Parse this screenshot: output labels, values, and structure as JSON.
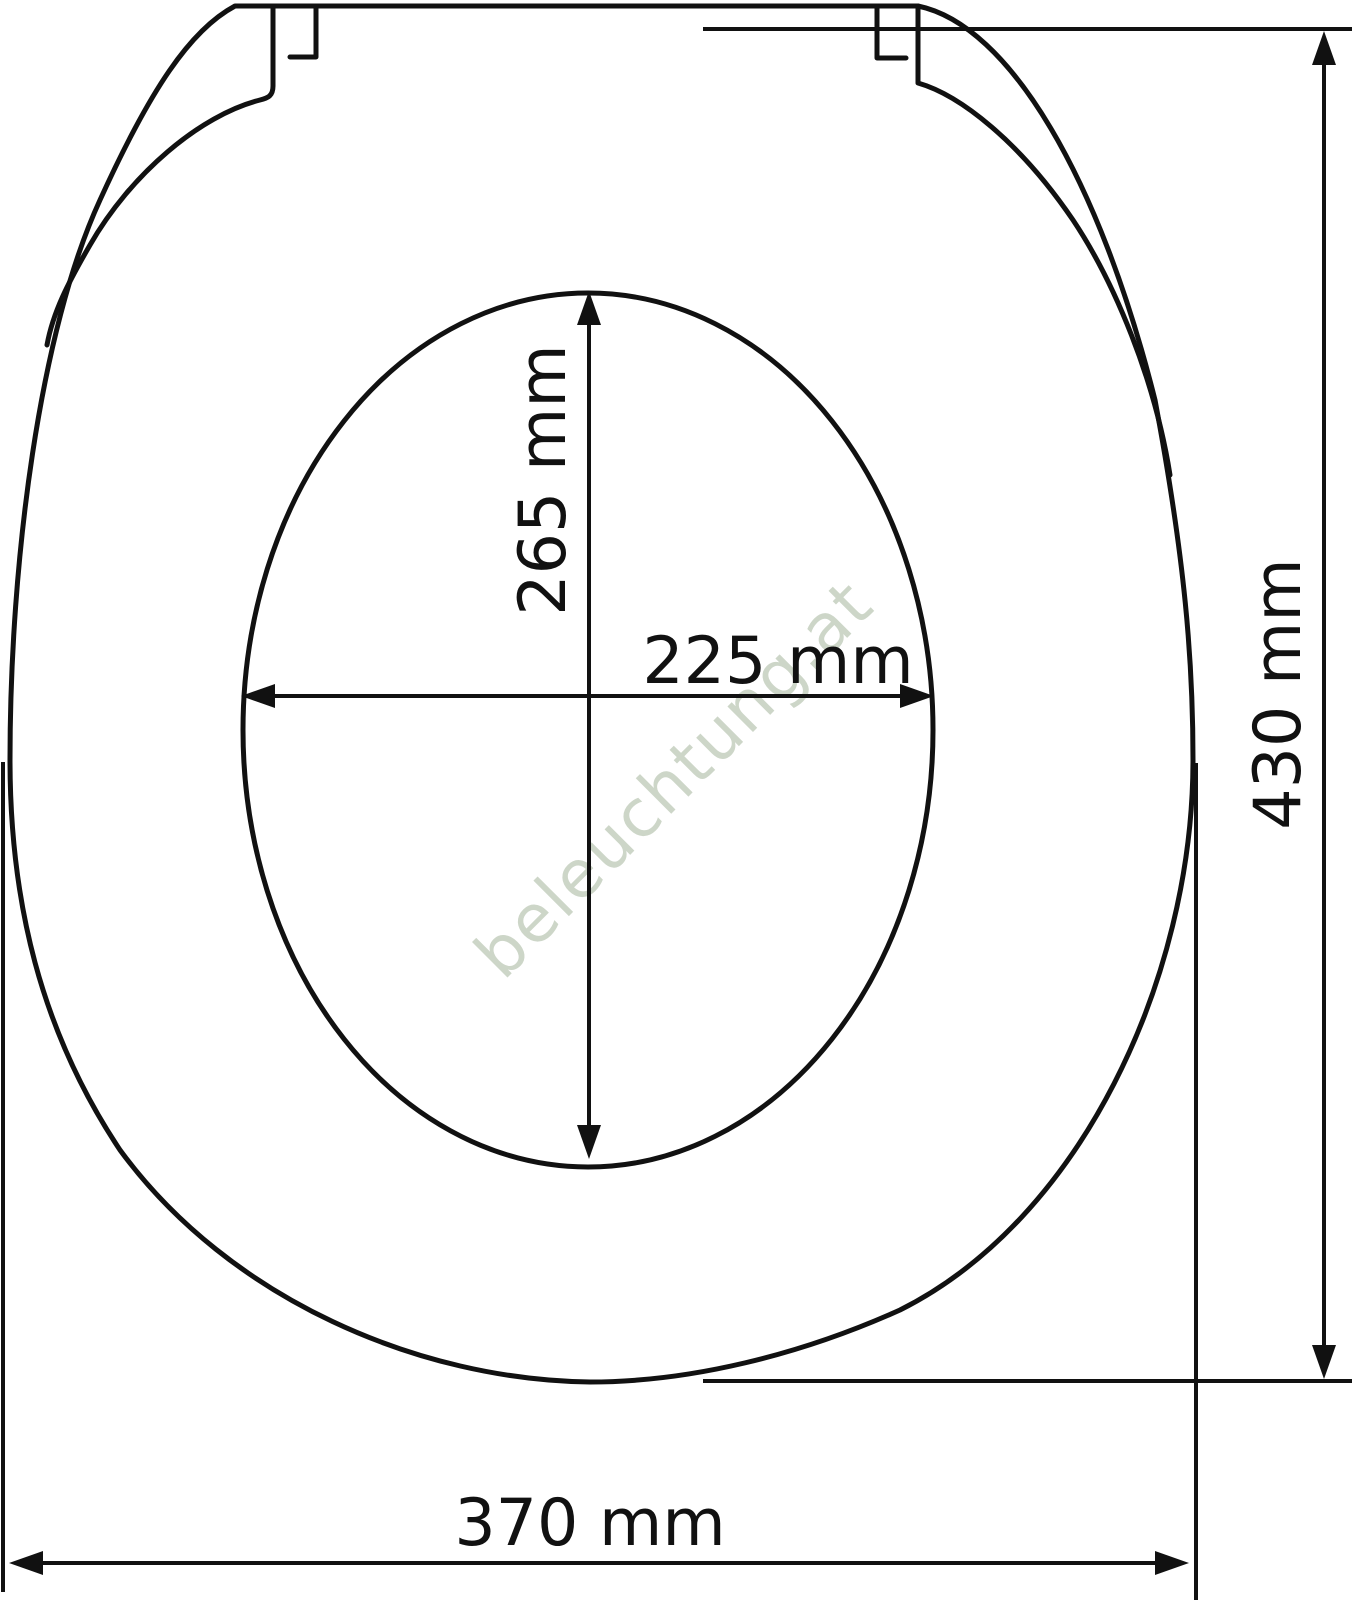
{
  "diagram": {
    "type": "technical-dimension-drawing",
    "subject": "toilet-seat-top-view",
    "background_color": "#ffffff",
    "line_color": "#111111",
    "watermark": {
      "text": "beleuchtung.at",
      "color": "#cdd6c8"
    },
    "dimensions": {
      "inner_opening_height": {
        "label": "265 mm",
        "value": 265,
        "unit": "mm",
        "orientation": "vertical"
      },
      "inner_opening_width": {
        "label": "225 mm",
        "value": 225,
        "unit": "mm",
        "orientation": "horizontal"
      },
      "overall_length": {
        "label": "430 mm",
        "value": 430,
        "unit": "mm",
        "orientation": "vertical"
      },
      "overall_width": {
        "label": "370 mm",
        "value": 370,
        "unit": "mm",
        "orientation": "horizontal"
      }
    }
  }
}
